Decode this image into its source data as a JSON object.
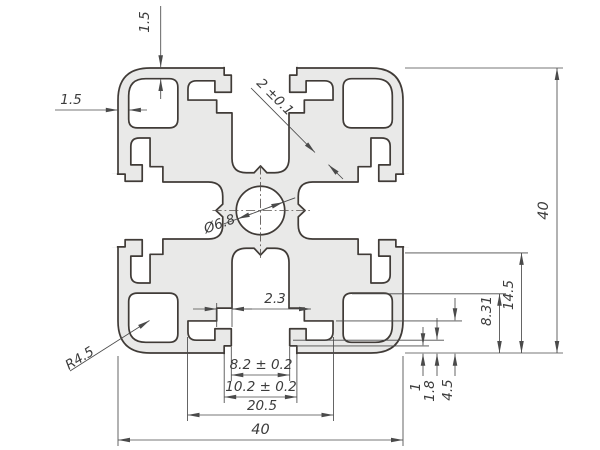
{
  "drawing": {
    "title": "aluminium-extrusion-profile-40x40-cross-section",
    "colors": {
      "background": "#ffffff",
      "profile_fill": "#e9e9e8",
      "profile_line": "#403b37",
      "dimension_line": "#4a4a4a",
      "text": "#3c3c3c"
    },
    "dimensions": {
      "top_wall_thickness": "1.5",
      "left_wall_thickness": "1.5",
      "web_thickness": "2 ±0.1",
      "center_bore": "Ø6.8",
      "corner_radius": "R4.5",
      "slot_step": "2.3",
      "slot_inner_width": "8.2 ± 0.2",
      "slot_opening_width": "10.2 ± 0.2",
      "slot_cavity_width": "20.5",
      "overall_width": "40",
      "overall_height": "40",
      "slot_feature_height": "14.5",
      "chamber_height": "8.31",
      "lip_recess_depth": "1",
      "lip_pocket_depth": "1.8",
      "slot_depth": "4.5"
    }
  }
}
